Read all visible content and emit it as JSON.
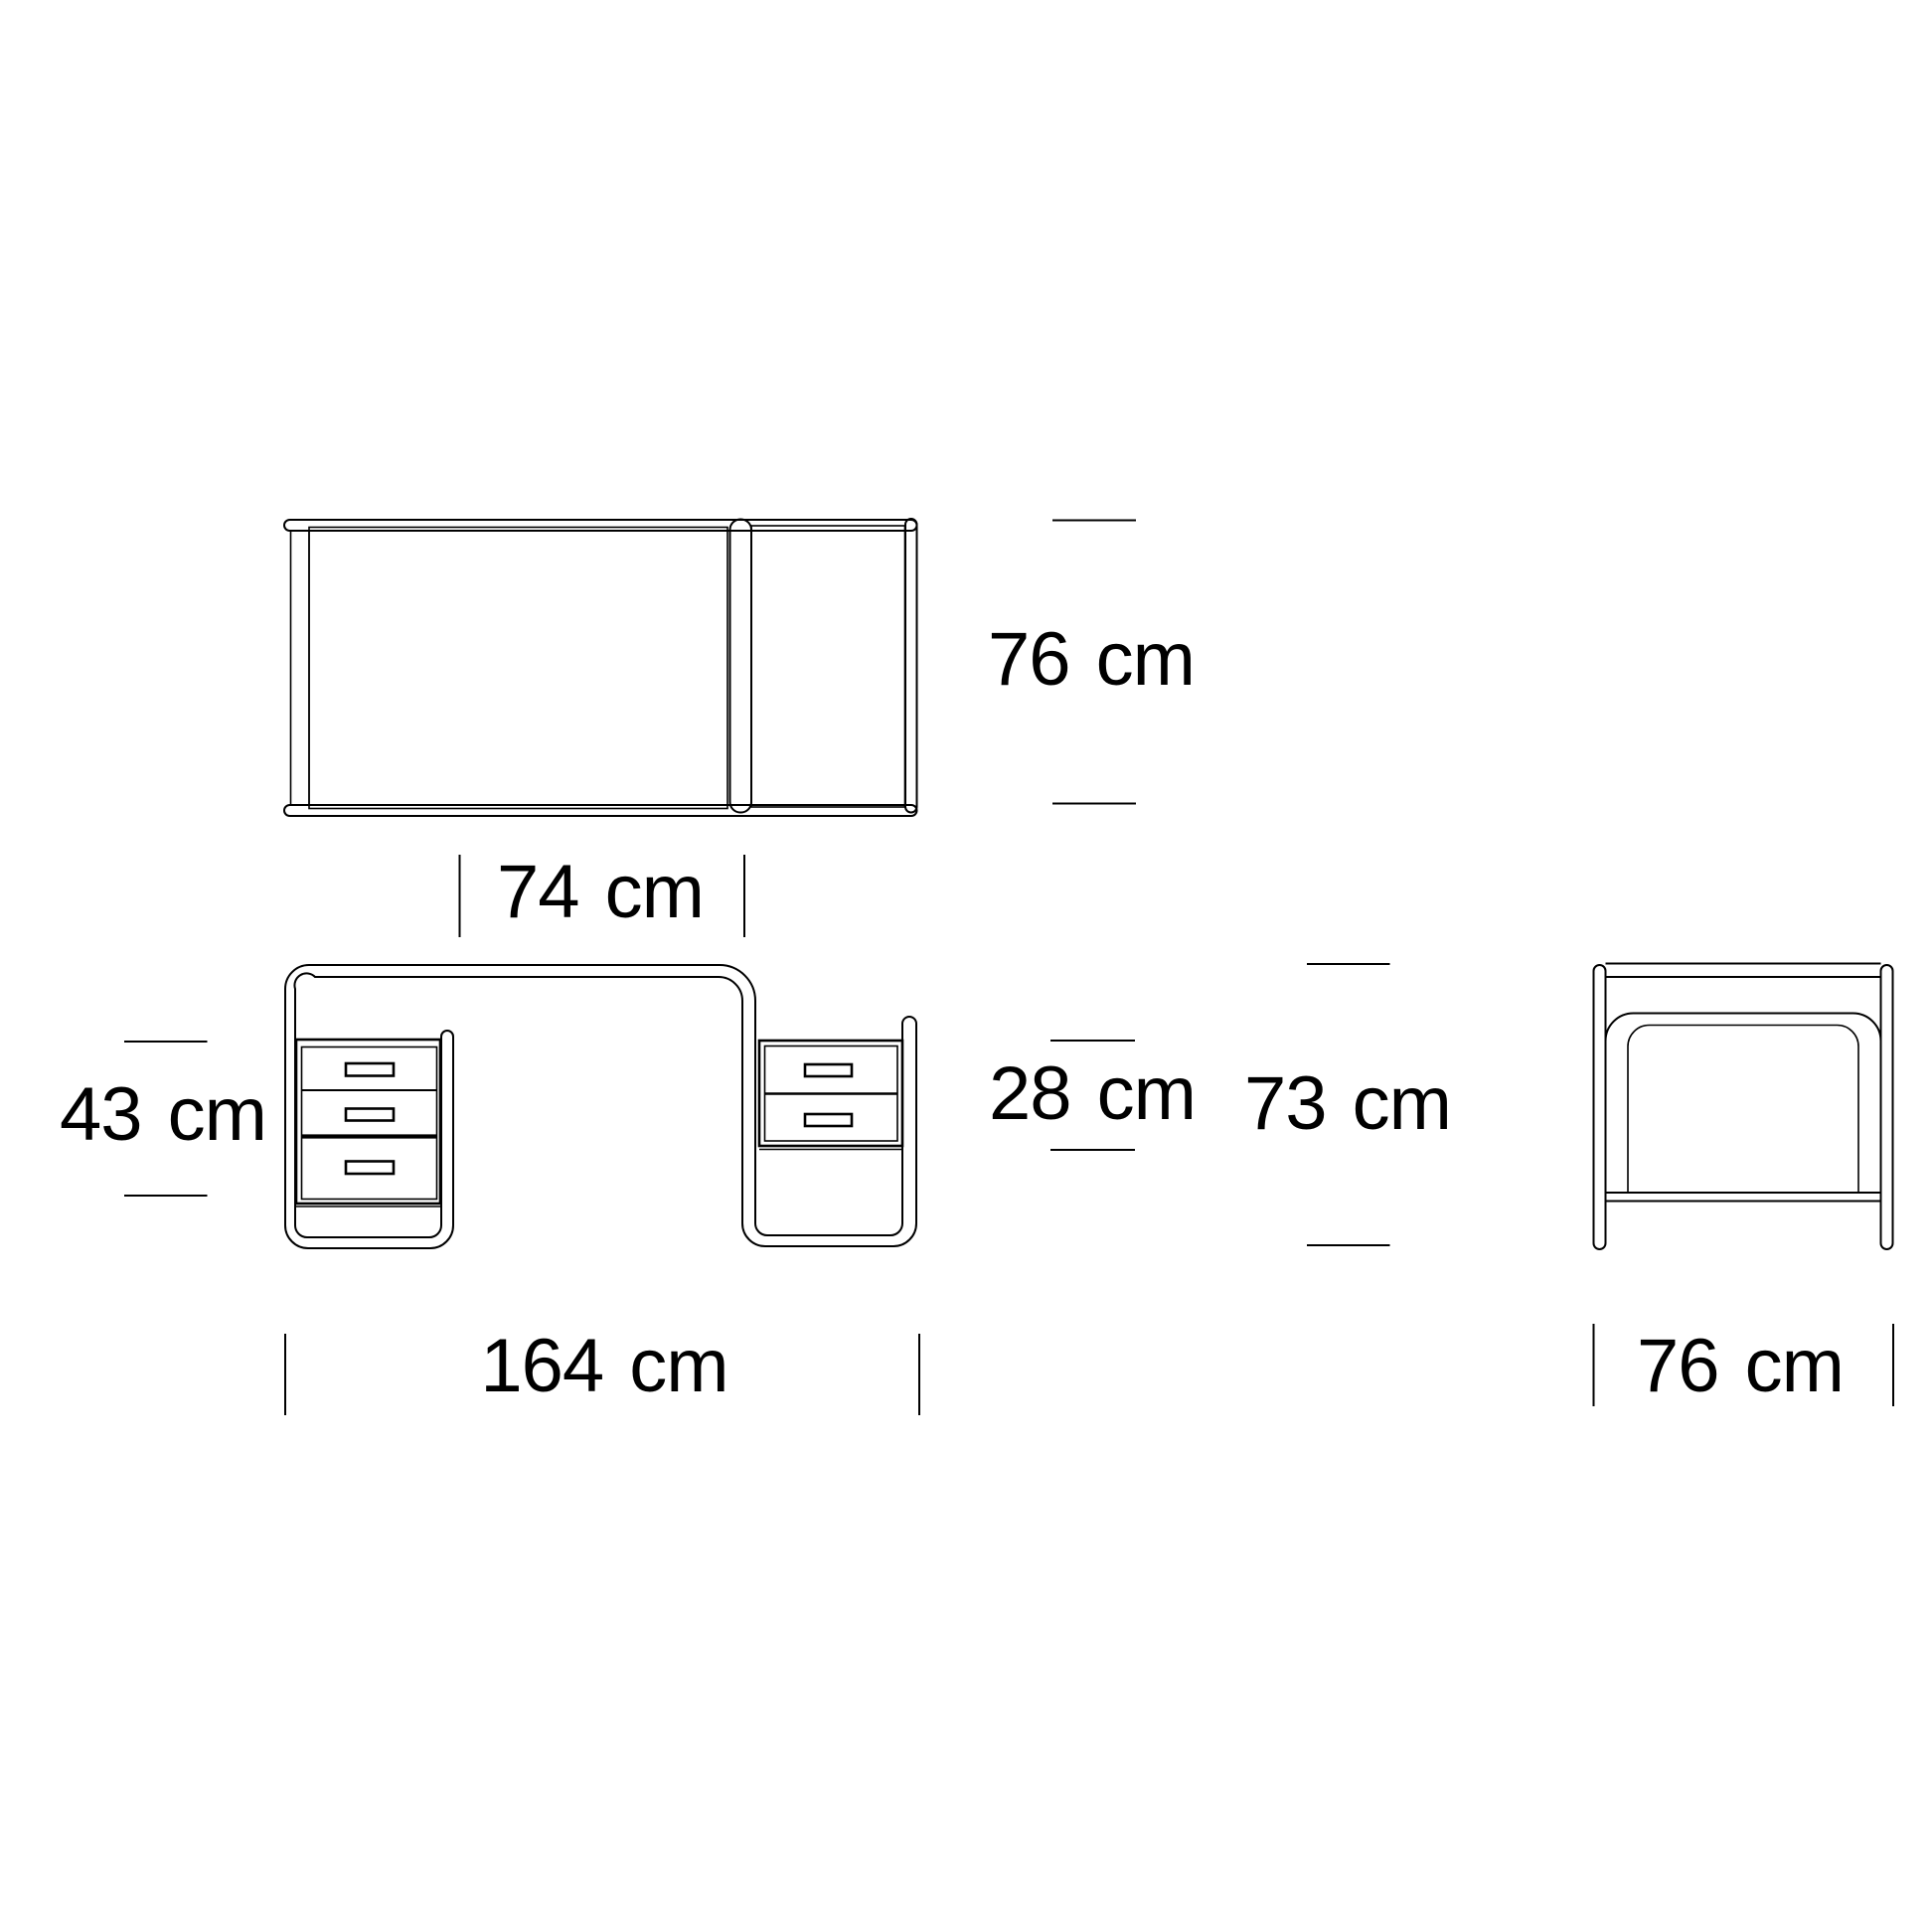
{
  "colors": {
    "background": "#ffffff",
    "line": "#000000"
  },
  "labels": {
    "top_depth": "76 cm",
    "knee_width": "74 cm",
    "left_unit_height": "43 cm",
    "right_unit_height": "28 cm",
    "overall_height": "73 cm",
    "overall_width": "164 cm",
    "side_depth": "76 cm"
  }
}
